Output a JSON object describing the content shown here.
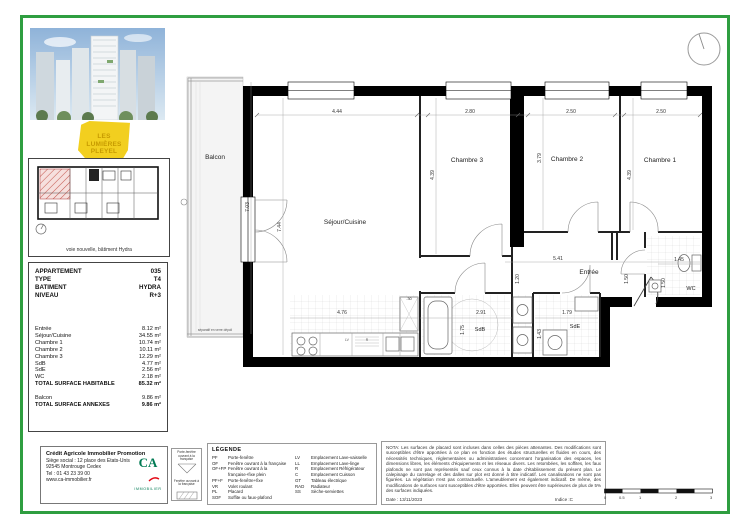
{
  "project": {
    "logo_lines": [
      "LES",
      "LUMIÈRES",
      "PLEYEL"
    ],
    "site_caption": "voie nouvelle, bâtiment Hydra"
  },
  "apartment": {
    "header": [
      {
        "label": "APPARTEMENT",
        "value": "035"
      },
      {
        "label": "TYPE",
        "value": "T4"
      },
      {
        "label": "BATIMENT",
        "value": "HYDRA"
      },
      {
        "label": "NIVEAU",
        "value": "R+3"
      }
    ],
    "areas": [
      {
        "label": "Entrée",
        "value": "8.12 m²"
      },
      {
        "label": "Séjour/Cuisine",
        "value": "34.55 m²"
      },
      {
        "label": "Chambre 1",
        "value": "10.74 m²"
      },
      {
        "label": "Chambre 2",
        "value": "10.11 m²"
      },
      {
        "label": "Chambre 3",
        "value": "12.29 m²"
      },
      {
        "label": "SdB",
        "value": "4.77 m²"
      },
      {
        "label": "SdE",
        "value": "2.56 m²"
      },
      {
        "label": "WC",
        "value": "2.18 m²"
      },
      {
        "label": "TOTAL SURFACE HABITABLE",
        "value": "85.32 m²"
      }
    ],
    "annexes": [
      {
        "label": "Balcon",
        "value": "9.86 m²"
      },
      {
        "label": "TOTAL SURFACE ANNEXES",
        "value": "9.86 m²"
      }
    ]
  },
  "plan": {
    "rooms": {
      "balcon": "Balcon",
      "sejour": "Séjour/Cuisine",
      "chambre3": "Chambre 3",
      "chambre2": "Chambre 2",
      "chambre1": "Chambre 1",
      "entree": "Entrée",
      "sdb": "SdB",
      "sde": "SdE",
      "wc": "WC",
      "separatif": "séparatif en verre dépoli",
      "mark1": "LV",
      "mark2": "R"
    },
    "dims": {
      "sejour_w": "4.44",
      "sejour_h": "7.44",
      "balcon_h": "7.03",
      "ch3_w": "2.80",
      "ch3_h": "4.39",
      "ch2_w": "2.50",
      "ch2_h": "3.79",
      "ch1_w": "2.50",
      "ch1_h": "4.39",
      "entree_w": "5.41",
      "entree_d1": "1.20",
      "entree_d2": "1.50",
      "sdb_w": "2.91",
      "sdb_h": "1.75",
      "sde_w": "1.79",
      "sde_h": "1.43",
      "wc_w": "1.45",
      "wc_h": "1.50",
      "kitchen_w": "4.76",
      "kitchen_d": ".30"
    }
  },
  "window_legend": {
    "item1": "Porte-fenêtre ouvrant à la française",
    "item2": "Fenêtre ouvrant à la française"
  },
  "legend": {
    "title": "LÉGENDE",
    "left": [
      {
        "code": "PF",
        "desc": "Porte-fenêtre"
      },
      {
        "code": "OF",
        "desc": "Fenêtre ouvrant à la française"
      },
      {
        "code": "OF+FP",
        "desc": "Fenêtre ouvrant à la française+fixe plein"
      },
      {
        "code": "PF+F",
        "desc": "Porte-fenêtre+fixe"
      },
      {
        "code": "VR",
        "desc": "Volet roulant"
      },
      {
        "code": "PL",
        "desc": "Placard"
      },
      {
        "code": "SOF",
        "desc": "Soffite ou faux-plafond"
      }
    ],
    "right": [
      {
        "code": "LV",
        "desc": "Emplacement Lave-vaisselle"
      },
      {
        "code": "LL",
        "desc": "Emplacement Lave-linge"
      },
      {
        "code": "R",
        "desc": "Emplacement Réfrigérateur"
      },
      {
        "code": "C",
        "desc": "Emplacement Cuisson"
      },
      {
        "code": "GT",
        "desc": "Tableau électrique"
      },
      {
        "code": "RAD",
        "desc": "Radiateur"
      },
      {
        "code": "SS",
        "desc": "Sèche-serviettes"
      }
    ]
  },
  "nota": {
    "text": "NOTA: Les surfaces de placard sont incluses dans celles des pièces attenantes. Des modifications sont susceptibles d'être apportées à ce plan en fonction des études structurelles et fluides en cours, des nécessités techniques, réglementaires ou administratives concernant l'organisation des espaces, les dimensions libres, les éléments d'équipements et les réseaux divers. Les retombées, les soffites, les faux plafonds ne sont pas représentés sauf ceux connus à la date d'établissement du présent plan. Le calepinage du carrelage et des dalles sur plot est donné à titre indicatif. Les canalisations ne sont pas figurées. La végétation n'est pas contractuelle. L'ameublement est également indicatif. De même, des modifications de surfaces sont susceptibles d'être apportées. Elles peuvent être supérieures de plus de 5% des surfaces indiquées.",
    "date": "Date : 13/11/2023",
    "indice": "Indice :C"
  },
  "promoter": {
    "name": "Crédit Agricole Immobilier Promotion",
    "lines": [
      "Siège social : 12 place des Etats-Unis",
      "92545 Montrouge Cedex",
      "Tel : 01 43 23 39 00",
      "www.ca-immobilier.fr"
    ],
    "logo_text": "CA",
    "logo_sub": "IMMOBILIER"
  },
  "scalebar": {
    "labels": [
      "0",
      "0.5",
      "1",
      "2",
      "3"
    ]
  },
  "colors": {
    "frame_green": "#2f9e40",
    "logo_yellow": "#f2cf1f",
    "ca_green": "#007a53",
    "ca_red": "#e30613",
    "hatch_red": "#c65b52",
    "wall_black": "#000000"
  }
}
